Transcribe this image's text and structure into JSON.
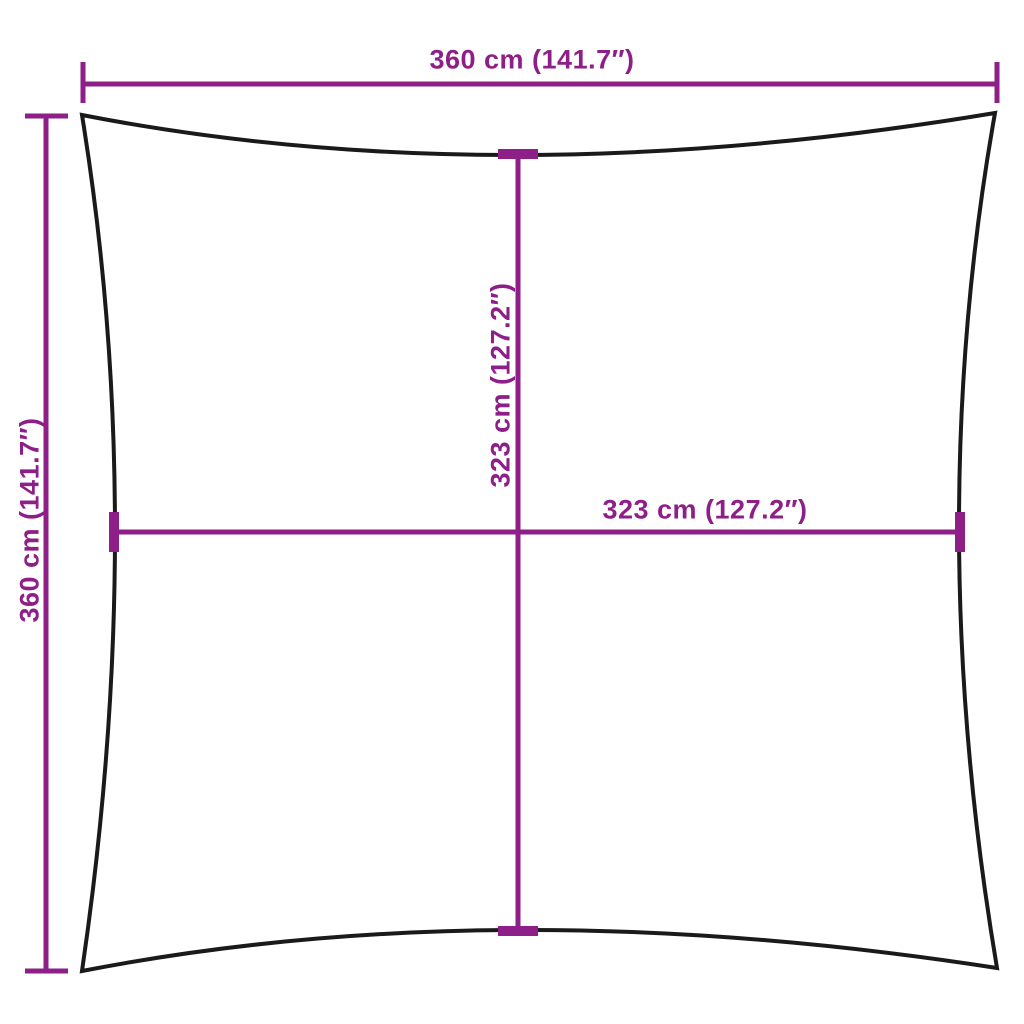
{
  "colors": {
    "accent": "#8E1F89",
    "sail_outline": "#1A1A1A",
    "background": "#FFFFFF"
  },
  "diagram": {
    "type": "product-dimension-diagram",
    "subject": "square shade sail with concave edges",
    "labels": {
      "top_width": "360 cm (141.7″)",
      "left_height": "360 cm (141.7″)",
      "inner_width": "323 cm (127.2″)",
      "inner_height": "323 cm (127.2″)"
    }
  }
}
